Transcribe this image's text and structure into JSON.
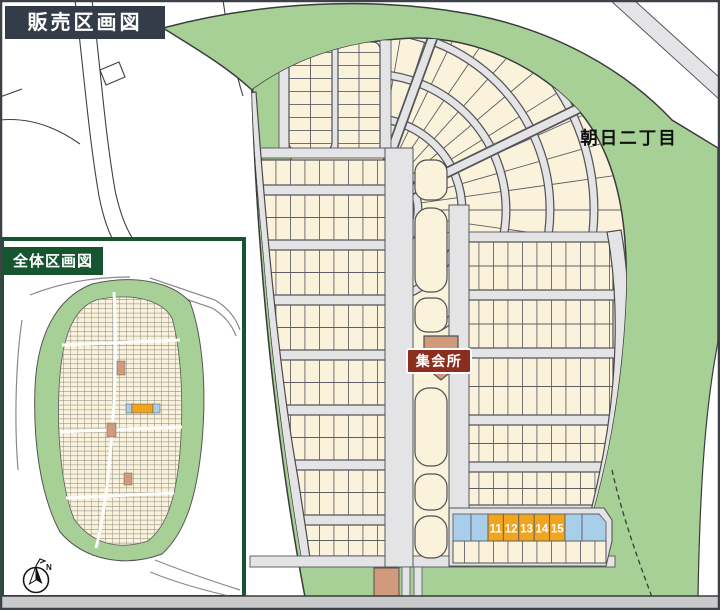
{
  "badges": {
    "sales_map_title": "販売区画図",
    "overall_map_title": "全体区画図",
    "meeting_hall": "集会所"
  },
  "labels": {
    "district": "朝日二丁目",
    "compass_north": "N"
  },
  "highlighted_lots": [
    {
      "number": "11"
    },
    {
      "number": "12"
    },
    {
      "number": "13"
    },
    {
      "number": "14"
    },
    {
      "number": "15"
    }
  ],
  "colors": {
    "lot_fill": "#FBF2DC",
    "road_fill": "#E4E4E7",
    "greenery": "#A7D097",
    "highlight_lot": "#F0A51E",
    "reserved_lot": "#A9CEE9",
    "facility_lot": "#D19A7C",
    "meeting_hall_badge": "#8C2E1F",
    "title_badge": "#343C49",
    "inset_border": "#175430"
  }
}
